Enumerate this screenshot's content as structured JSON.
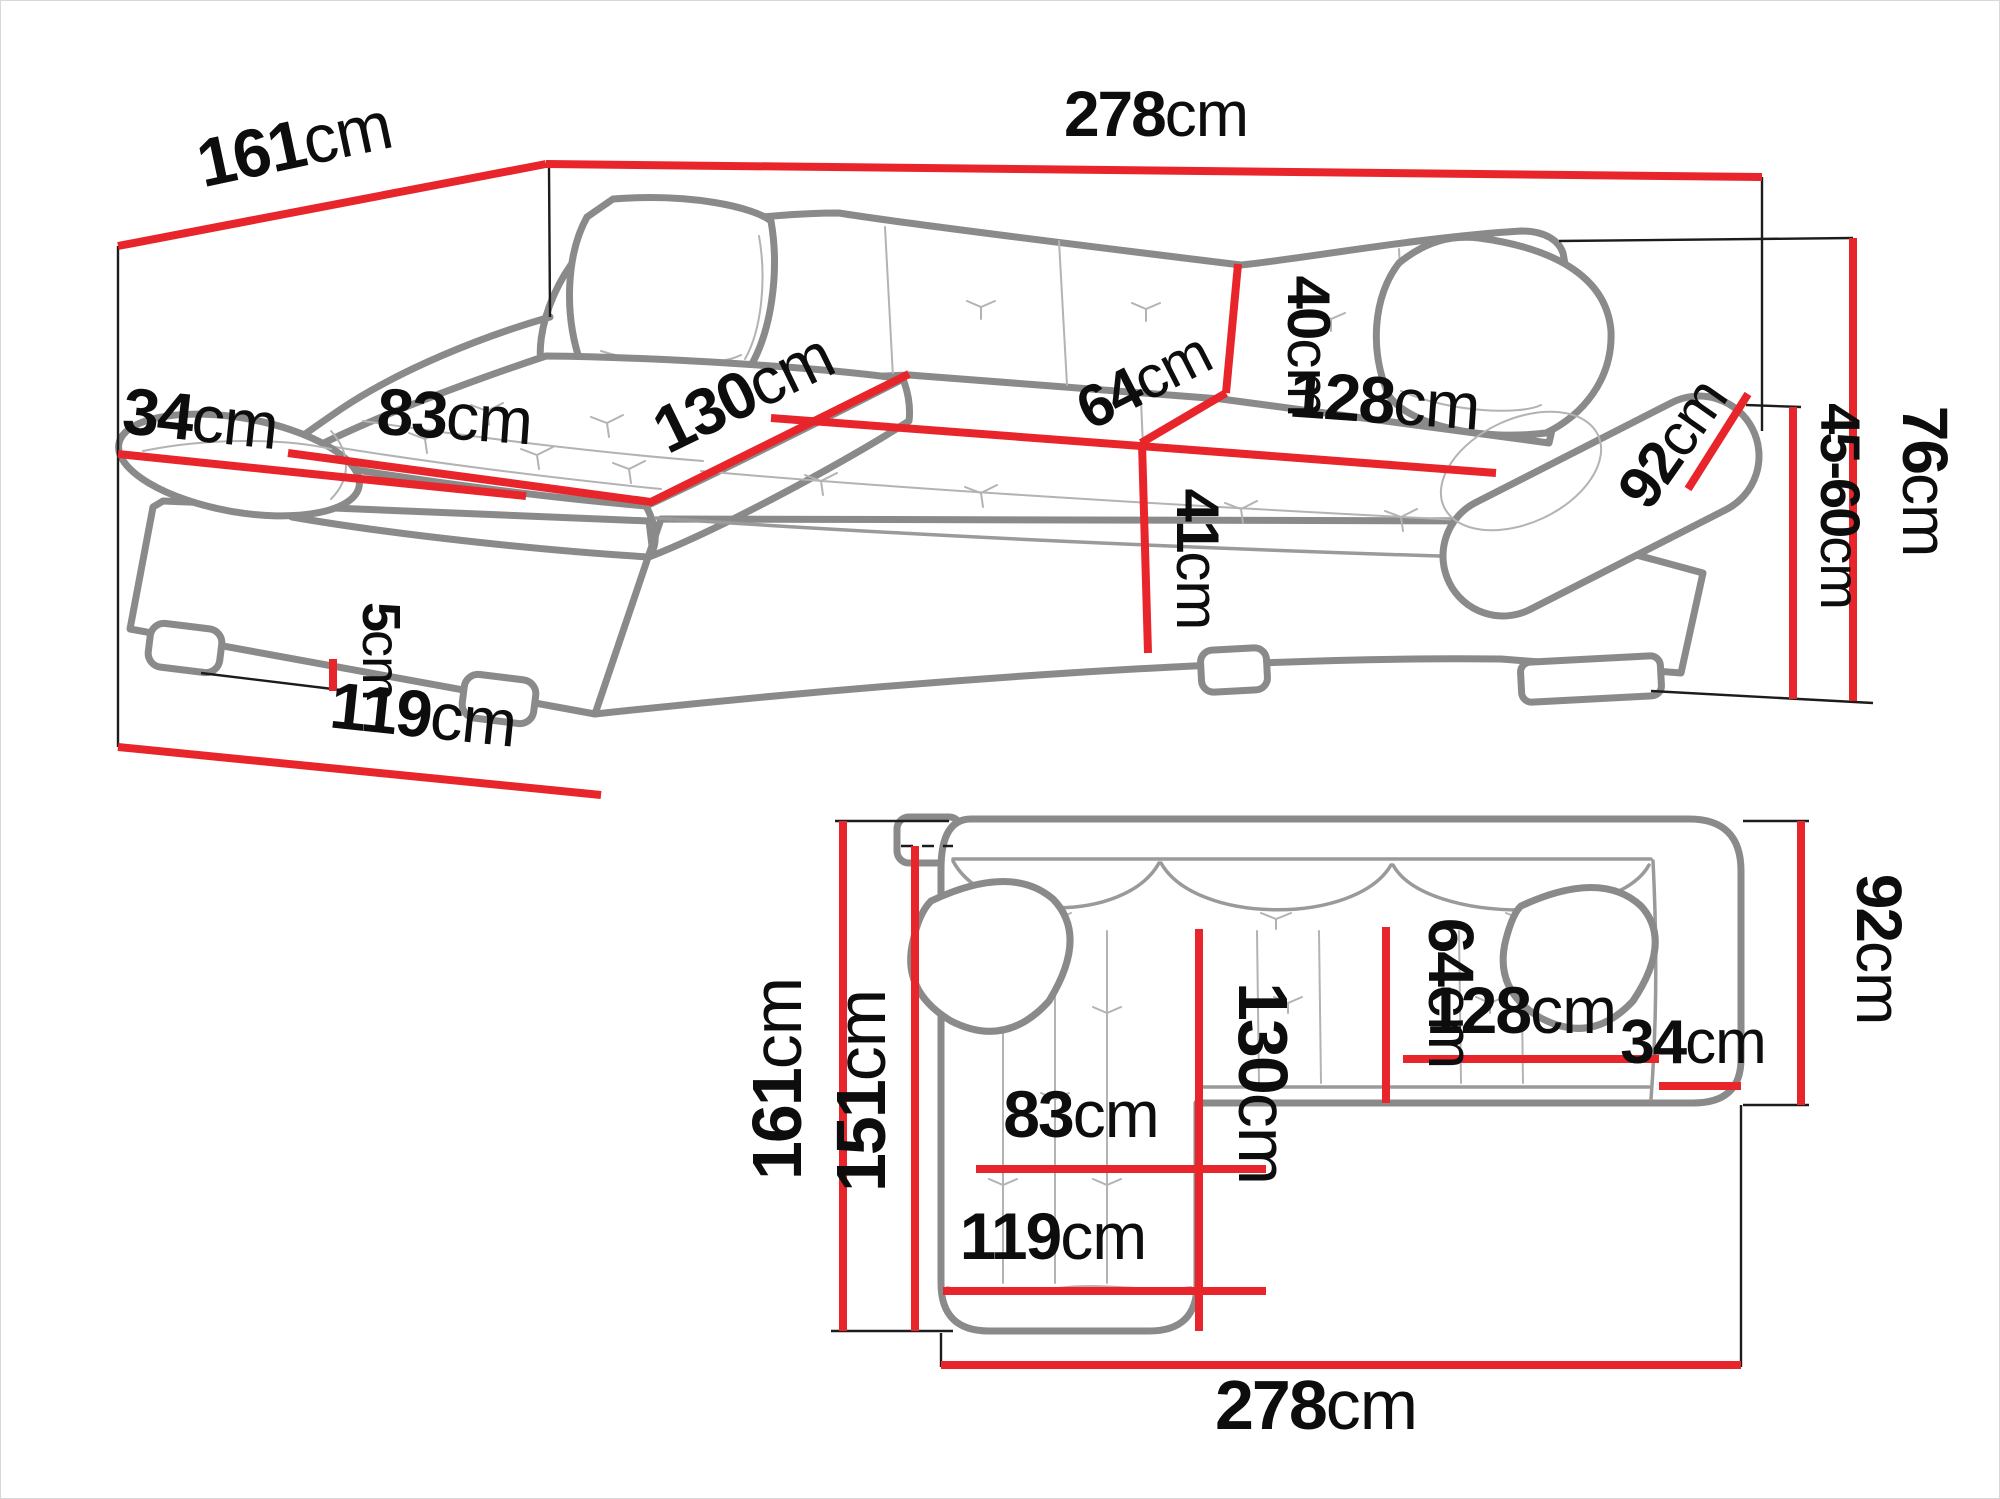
{
  "colors": {
    "dimension_line": "#e8252b",
    "sofa_outline": "#8a8a8a",
    "sofa_detail": "#b3b3b3",
    "tick_line": "#1c1c1c",
    "label_text": "#0d0d0d",
    "background": "#ffffff"
  },
  "perspective": {
    "total_width": {
      "value": "278",
      "unit": "cm"
    },
    "total_depth": {
      "value": "161",
      "unit": "cm"
    },
    "armrest_width": {
      "value": "34",
      "unit": "cm"
    },
    "chaise_seat_width": {
      "value": "83",
      "unit": "cm"
    },
    "chaise_seat_length": {
      "value": "130",
      "unit": "cm"
    },
    "backrest_height": {
      "value": "40",
      "unit": "cm"
    },
    "seat_depth": {
      "value": "64",
      "unit": "cm"
    },
    "seat_width": {
      "value": "128",
      "unit": "cm"
    },
    "armrest_length": {
      "value": "92",
      "unit": "cm"
    },
    "seat_height": {
      "value": "41",
      "unit": "cm"
    },
    "total_height": {
      "value": "76",
      "unit": "cm"
    },
    "armrest_height_range": {
      "value": "45-60",
      "unit": "cm"
    },
    "leg_height": {
      "value": "5",
      "unit": "cm"
    },
    "chaise_depth": {
      "value": "119",
      "unit": "cm"
    }
  },
  "plan": {
    "total_depth": {
      "value": "161",
      "unit": "cm"
    },
    "inner_depth": {
      "value": "151",
      "unit": "cm"
    },
    "chaise_length": {
      "value": "130",
      "unit": "cm"
    },
    "seat_depth": {
      "value": "64",
      "unit": "cm"
    },
    "chaise_width": {
      "value": "83",
      "unit": "cm"
    },
    "chaise_total_width": {
      "value": "119",
      "unit": "cm"
    },
    "seat_width": {
      "value": "128",
      "unit": "cm"
    },
    "armrest_width": {
      "value": "34",
      "unit": "cm"
    },
    "armrest_length": {
      "value": "92",
      "unit": "cm"
    },
    "total_width": {
      "value": "278",
      "unit": "cm"
    }
  }
}
